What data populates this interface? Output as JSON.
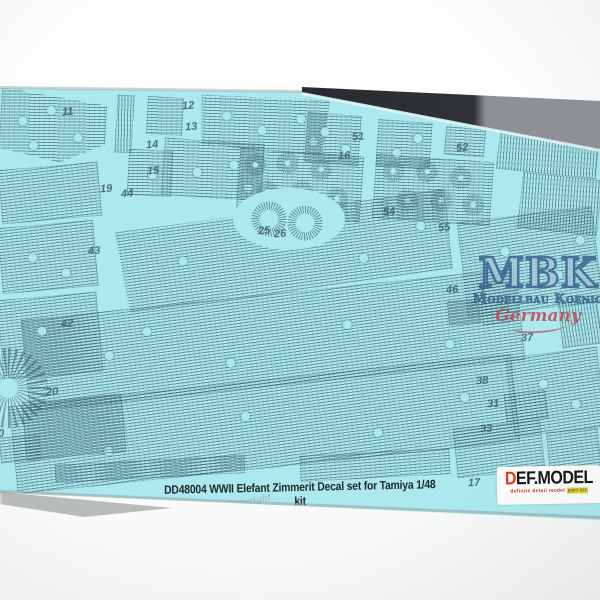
{
  "photo": {
    "caption": "DD48004 WWII Elefant Zimmerit Decal set for Tamiya 1/48 kit",
    "copyright_text": "Copyright",
    "sheet_color": "#ace9ef",
    "zimmerit_line_color": "#46707c",
    "caption_color": "#20262b"
  },
  "watermark": {
    "initials": "MBK",
    "name": "Modellbau Koenig",
    "country": "Germany",
    "blue": "#3c6b9a",
    "red": "#c4414e"
  },
  "brand": {
    "initial": "D",
    "rest": "EF.MODEL",
    "tagline_left": "definite detail model ",
    "tagline_right": "part kit",
    "red": "#e23a1c",
    "highlight": "#c6e23a"
  },
  "part_numbers": [
    {
      "label": "11",
      "x": 62,
      "y": 106
    },
    {
      "label": "12",
      "x": 182,
      "y": 100
    },
    {
      "label": "13",
      "x": 185,
      "y": 121
    },
    {
      "label": "14",
      "x": 146,
      "y": 139
    },
    {
      "label": "15",
      "x": 147,
      "y": 165
    },
    {
      "label": "19",
      "x": 100,
      "y": 183
    },
    {
      "label": "44",
      "x": 121,
      "y": 188
    },
    {
      "label": "51",
      "x": 352,
      "y": 131
    },
    {
      "label": "16",
      "x": 338,
      "y": 150
    },
    {
      "label": "52",
      "x": 456,
      "y": 142
    },
    {
      "label": "54",
      "x": 383,
      "y": 206
    },
    {
      "label": "55",
      "x": 438,
      "y": 222
    },
    {
      "label": "25",
      "x": 258,
      "y": 225
    },
    {
      "label": "26",
      "x": 274,
      "y": 228
    },
    {
      "label": "43",
      "x": 88,
      "y": 245
    },
    {
      "label": "42",
      "x": 61,
      "y": 318
    },
    {
      "label": "20",
      "x": 46,
      "y": 386
    },
    {
      "label": "30",
      "x": -8,
      "y": 428
    },
    {
      "label": "46",
      "x": 446,
      "y": 284
    },
    {
      "label": "7",
      "x": 479,
      "y": 286
    },
    {
      "label": "37",
      "x": 521,
      "y": 332
    },
    {
      "label": "38",
      "x": 476,
      "y": 375
    },
    {
      "label": "31",
      "x": 487,
      "y": 398
    },
    {
      "label": "33",
      "x": 480,
      "y": 423
    },
    {
      "label": "17",
      "x": 468,
      "y": 477
    }
  ]
}
